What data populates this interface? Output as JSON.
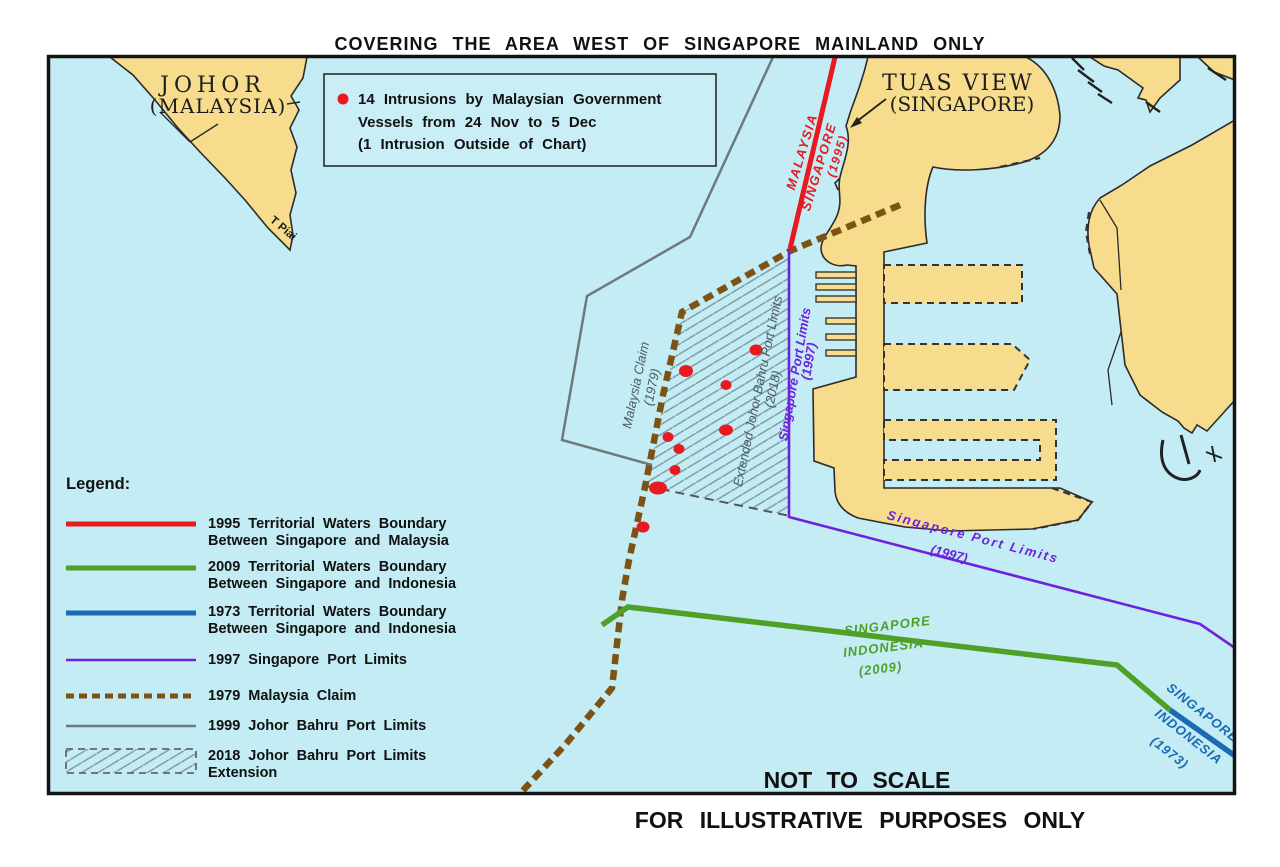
{
  "colors": {
    "water": "#c3ecf4",
    "land": "#f6dc8c",
    "coast": "#2b2b2b",
    "red": "#e8191f",
    "green": "#4fa026",
    "blue": "#1a6ab5",
    "purple": "#6e22dc",
    "brown": "#7d5215",
    "gray": "#6f797c",
    "hatch": "#7c98a0",
    "ink": "#111111"
  },
  "title": "COVERING THE AREA WEST OF SINGAPORE MAINLAND ONLY",
  "footer": "FOR ILLUSTRATIVE PURPOSES ONLY",
  "info_box": {
    "line1": "14 Intrusions by Malaysian Government",
    "line2": "Vessels from 24 Nov to 5 Dec",
    "line3": "(1 Intrusion Outside of Chart)"
  },
  "legend": {
    "heading": "Legend:",
    "items": [
      {
        "line1": "1995 Territorial Waters Boundary",
        "line2": "Between Singapore and Malaysia"
      },
      {
        "line1": "2009 Territorial Waters Boundary",
        "line2": "Between Singapore and Indonesia"
      },
      {
        "line1": "1973 Territorial Waters Boundary",
        "line2": "Between Singapore and Indonesia"
      },
      {
        "line1": "1997 Singapore Port Limits",
        "line2": ""
      },
      {
        "line1": "1979 Malaysia Claim",
        "line2": ""
      },
      {
        "line1": "1999 Johor Bahru Port Limits",
        "line2": ""
      },
      {
        "line1": "2018 Johor Bahru Port Limits",
        "line2": "Extension"
      }
    ]
  },
  "map": {
    "not_to_scale": "NOT TO SCALE",
    "labels": {
      "johor": "JOHOR",
      "johor_country": "(MALAYSIA)",
      "t_piai": "T Piai",
      "tuas": "TUAS VIEW",
      "tuas_country": "(SINGAPORE)",
      "b1995_malaysia": "MALAYSIA",
      "b1995_singapore": "SINGAPORE",
      "b1995_year": "(1995)",
      "claim": "Malaysia Claim",
      "claim_year": "(1979)",
      "ext": "Extended Johor Bahru Port Limits",
      "ext_year": "(2018)",
      "spl_v": "Singapore Port Limits",
      "spl_v_year": "(1997)",
      "spl_d": "Singapore Port Limits",
      "spl_d_year": "(1997)",
      "b2009_sg": "SINGAPORE",
      "b2009_id": "INDONESIA",
      "b2009_year": "(2009)",
      "b1973_sg": "SINGAPORE",
      "b1973_id": "INDONESIA",
      "b1973_year": "(1973)"
    },
    "intrusion_points": [
      {
        "x": 686,
        "y": 371,
        "rx": 7,
        "ry": 6
      },
      {
        "x": 726,
        "y": 385,
        "rx": 5.5,
        "ry": 5
      },
      {
        "x": 756,
        "y": 350,
        "rx": 6.5,
        "ry": 5.5
      },
      {
        "x": 668,
        "y": 437,
        "rx": 5.5,
        "ry": 5
      },
      {
        "x": 679,
        "y": 449,
        "rx": 5.5,
        "ry": 5
      },
      {
        "x": 726,
        "y": 430,
        "rx": 7,
        "ry": 5.5
      },
      {
        "x": 675,
        "y": 470,
        "rx": 5.5,
        "ry": 5
      },
      {
        "x": 658,
        "y": 488,
        "rx": 9,
        "ry": 6.5
      },
      {
        "x": 643,
        "y": 527,
        "rx": 6.5,
        "ry": 5.5
      }
    ]
  }
}
